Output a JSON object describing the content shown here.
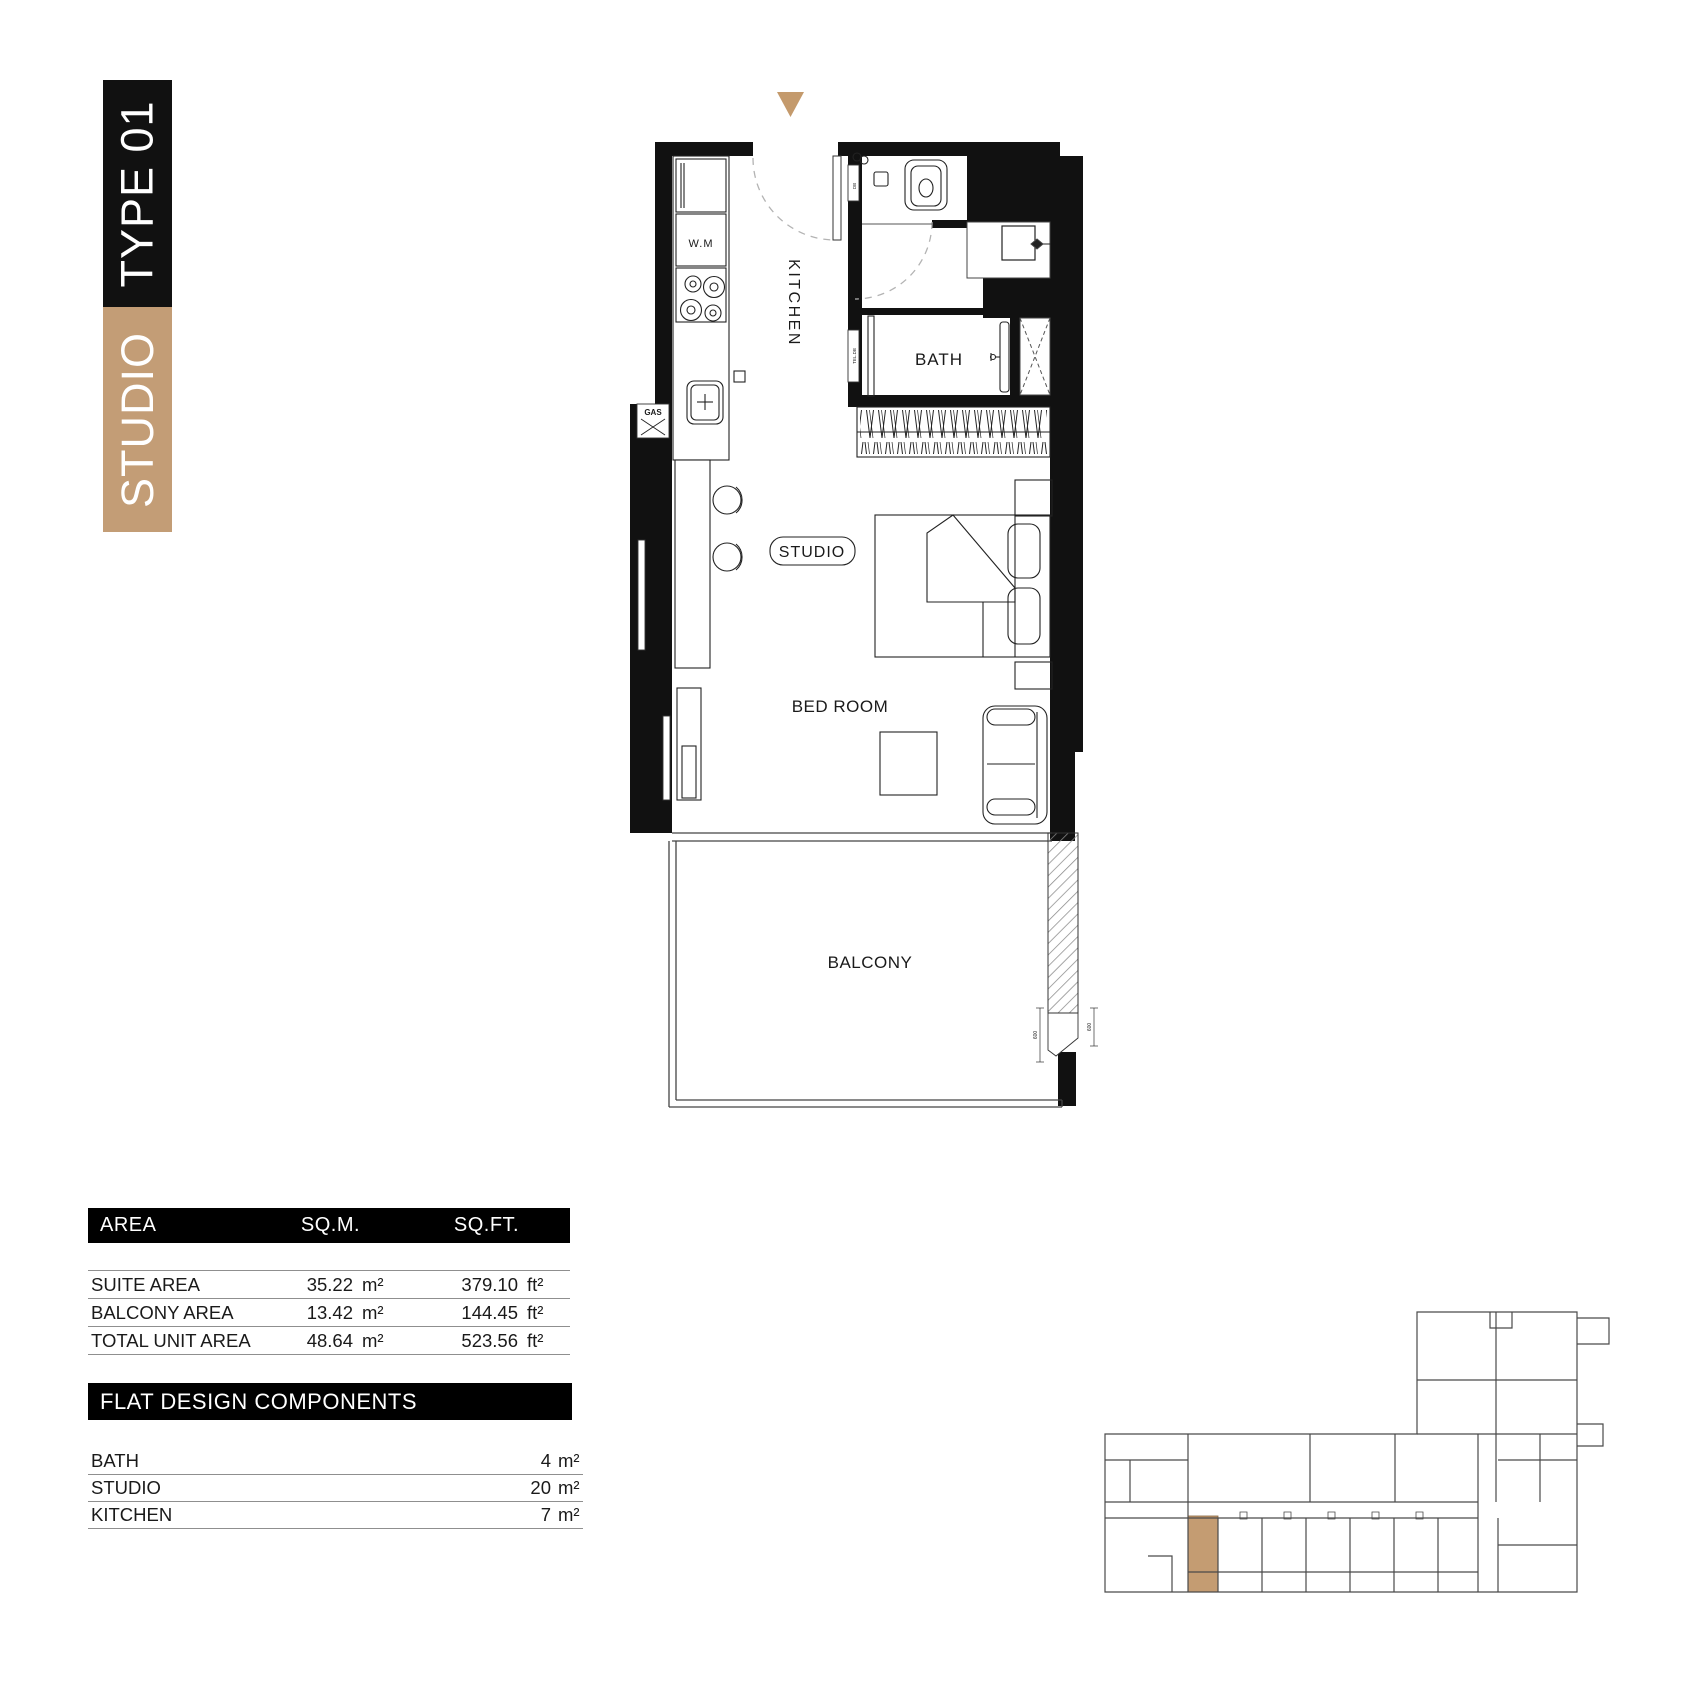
{
  "banner": {
    "studio_label": "STUDIO",
    "type_label": "TYPE 01"
  },
  "colors": {
    "banner_black": "#111111",
    "banner_tan": "#c39d76",
    "entrance_triangle_tan": "#c49a6c",
    "keyplan_highlight_tan": "#c49c72",
    "wall_black": "#111111"
  },
  "plan_labels": {
    "kitchen": "KITCHEN",
    "studio": "STUDIO",
    "bath": "BATH",
    "bedroom": "BED ROOM",
    "balcony": "BALCONY",
    "washing_machine": "W.M",
    "gas": "GAS",
    "db": "DB",
    "tel_db": "TEL.DB",
    "dim_a": "600",
    "dim_b": "600"
  },
  "area_table": {
    "col_area": "AREA",
    "col_sqm": "SQ.M.",
    "col_sqft": "SQ.FT.",
    "rows": [
      {
        "label": "SUITE AREA",
        "sqm": "35.22",
        "sqm_unit": "m²",
        "sqft": "379.10",
        "sqft_unit": "ft²"
      },
      {
        "label": "BALCONY AREA",
        "sqm": "13.42",
        "sqm_unit": "m²",
        "sqft": "144.45",
        "sqft_unit": "ft²"
      },
      {
        "label": "TOTAL UNIT AREA",
        "sqm": "48.64",
        "sqm_unit": "m²",
        "sqft": "523.56",
        "sqft_unit": "ft²"
      }
    ]
  },
  "components_table": {
    "title": "FLAT DESIGN COMPONENTS",
    "rows": [
      {
        "label": "BATH",
        "value": "4",
        "unit": "m²"
      },
      {
        "label": "STUDIO",
        "value": "20",
        "unit": "m²"
      },
      {
        "label": "KITCHEN",
        "value": "7",
        "unit": "m²"
      }
    ]
  }
}
